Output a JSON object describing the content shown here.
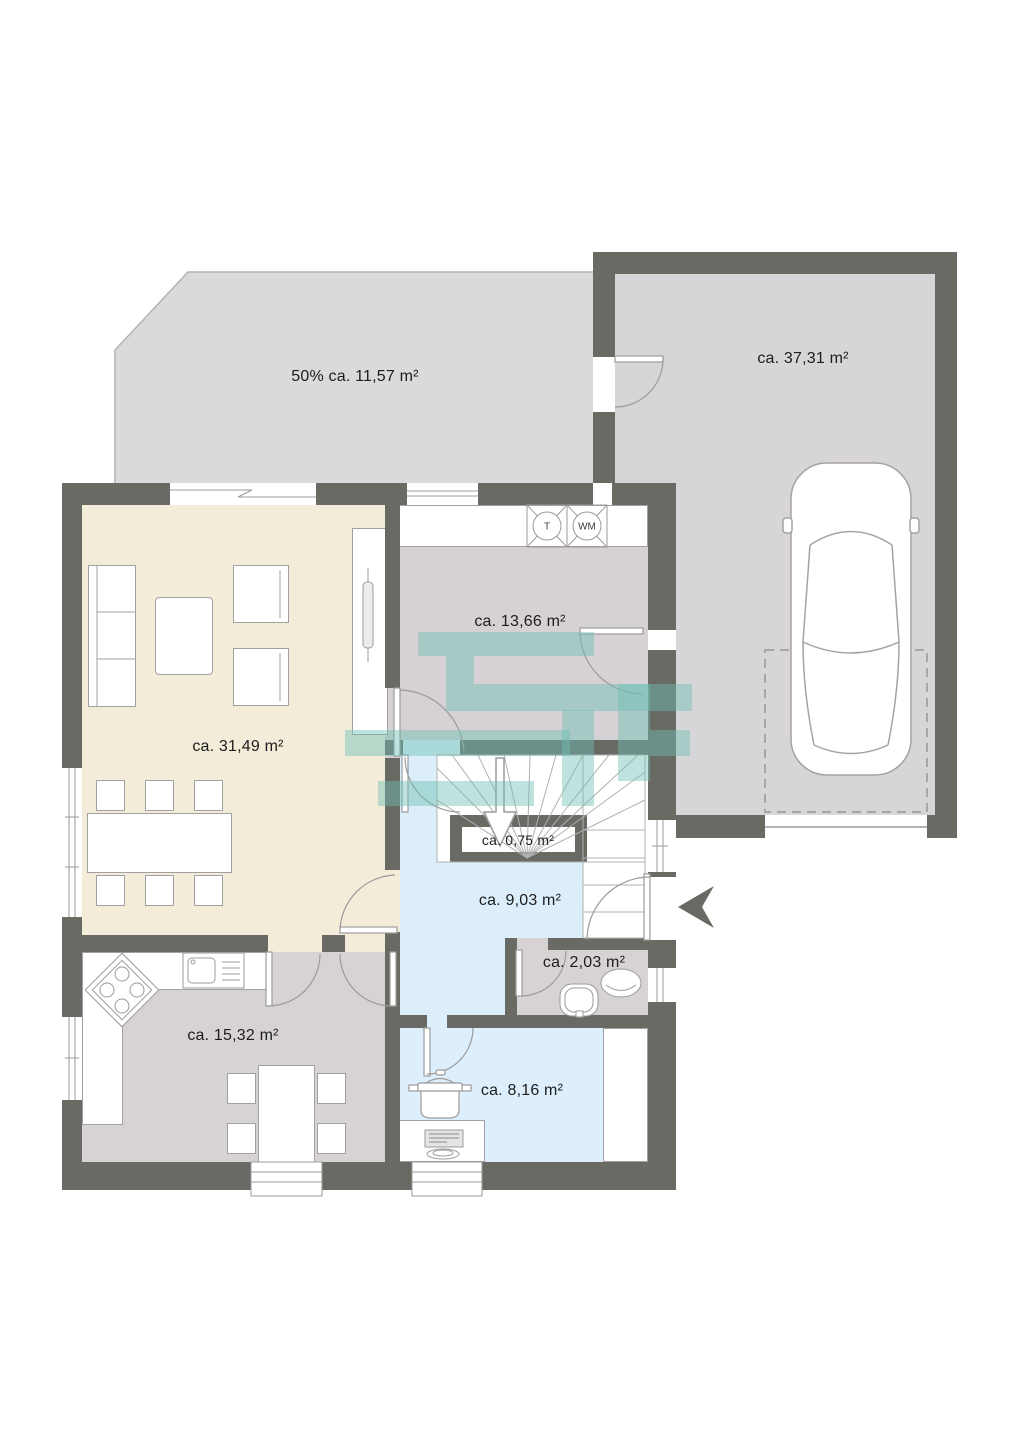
{
  "title": "Grundriss Erdgeschoss (floor plan)",
  "rooms": {
    "terrace": {
      "label": "50% ca. 11,57 m²"
    },
    "garage": {
      "label": "ca. 37,31 m²"
    },
    "utility": {
      "label": "ca. 13,66 m²"
    },
    "living": {
      "label": "ca. 31,49 m²"
    },
    "storage": {
      "label": "ca. 0,75 m²"
    },
    "hallway": {
      "label": "ca. 9,03 m²"
    },
    "wc": {
      "label": "ca. 2,03 m²"
    },
    "kitchen": {
      "label": "ca. 15,32 m²"
    },
    "workroom": {
      "label": "ca. 8,16 m²"
    }
  },
  "appliances": {
    "dryer": "T",
    "washer": "WM"
  },
  "colors": {
    "wall": "#6a6a64",
    "terrace_floor": "#dcd9dc",
    "garage_floor": "#d8d5d8",
    "utility_floor": "#d6d1d4",
    "living_floor": "#f3ecd9",
    "kitchen_floor": "#d7d3d5",
    "wc_floor": "#d7d3d5",
    "hallway_floor": "#dbeefa",
    "workroom_floor": "#ddeffc",
    "watermark": "#6fbfb4",
    "furniture_stroke": "#9b9b9b",
    "entrance_arrow": "#6a6a64"
  }
}
